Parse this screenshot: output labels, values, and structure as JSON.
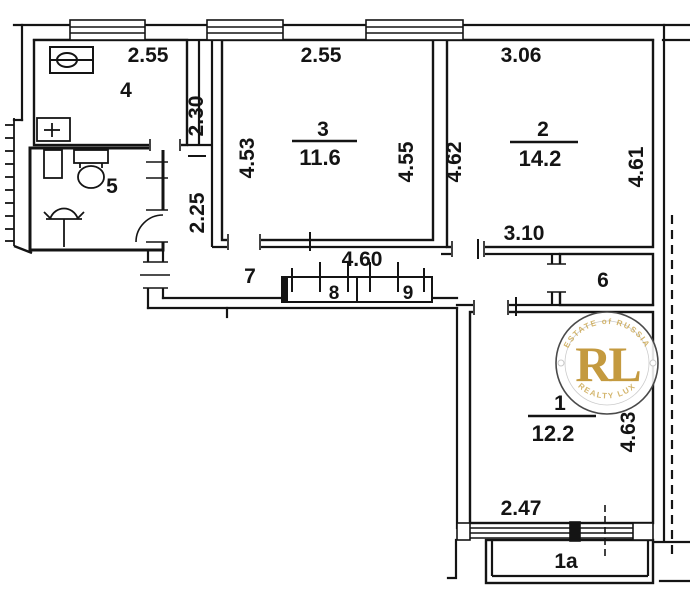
{
  "title": "Apartment floor plan (BTI scheme)",
  "colors": {
    "line": "#141414",
    "gold": "#c49a3f",
    "watermark_ring": "#4a4a4a"
  },
  "rooms": {
    "r1": {
      "number": "1",
      "area": "12.2",
      "dim_right": "4.63",
      "dim_bottom": "2.47"
    },
    "r2": {
      "number": "2",
      "area": "14.2",
      "dim_top": "3.06",
      "dim_left": "4.62",
      "dim_right": "4.61",
      "dim_bottom": "3.10"
    },
    "r3": {
      "number": "3",
      "area": "11.6",
      "dim_top": "2.55",
      "dim_left": "4.53",
      "dim_right": "4.55"
    },
    "r4": {
      "number": "4",
      "dim_top": "2.55",
      "dim_right": "2.30"
    },
    "r5": {
      "number": "5"
    },
    "r6": {
      "number": "6"
    },
    "r7": {
      "number": "7",
      "dim_top": "4.60",
      "dim_left": "2.25"
    },
    "r8": {
      "number": "8"
    },
    "r9": {
      "number": "9"
    },
    "balcony": {
      "number": "1a"
    }
  },
  "watermark": {
    "letters": "RL",
    "arc_top": "ESTATE of RUSSIA",
    "arc_bottom": "REALTY LUX"
  }
}
